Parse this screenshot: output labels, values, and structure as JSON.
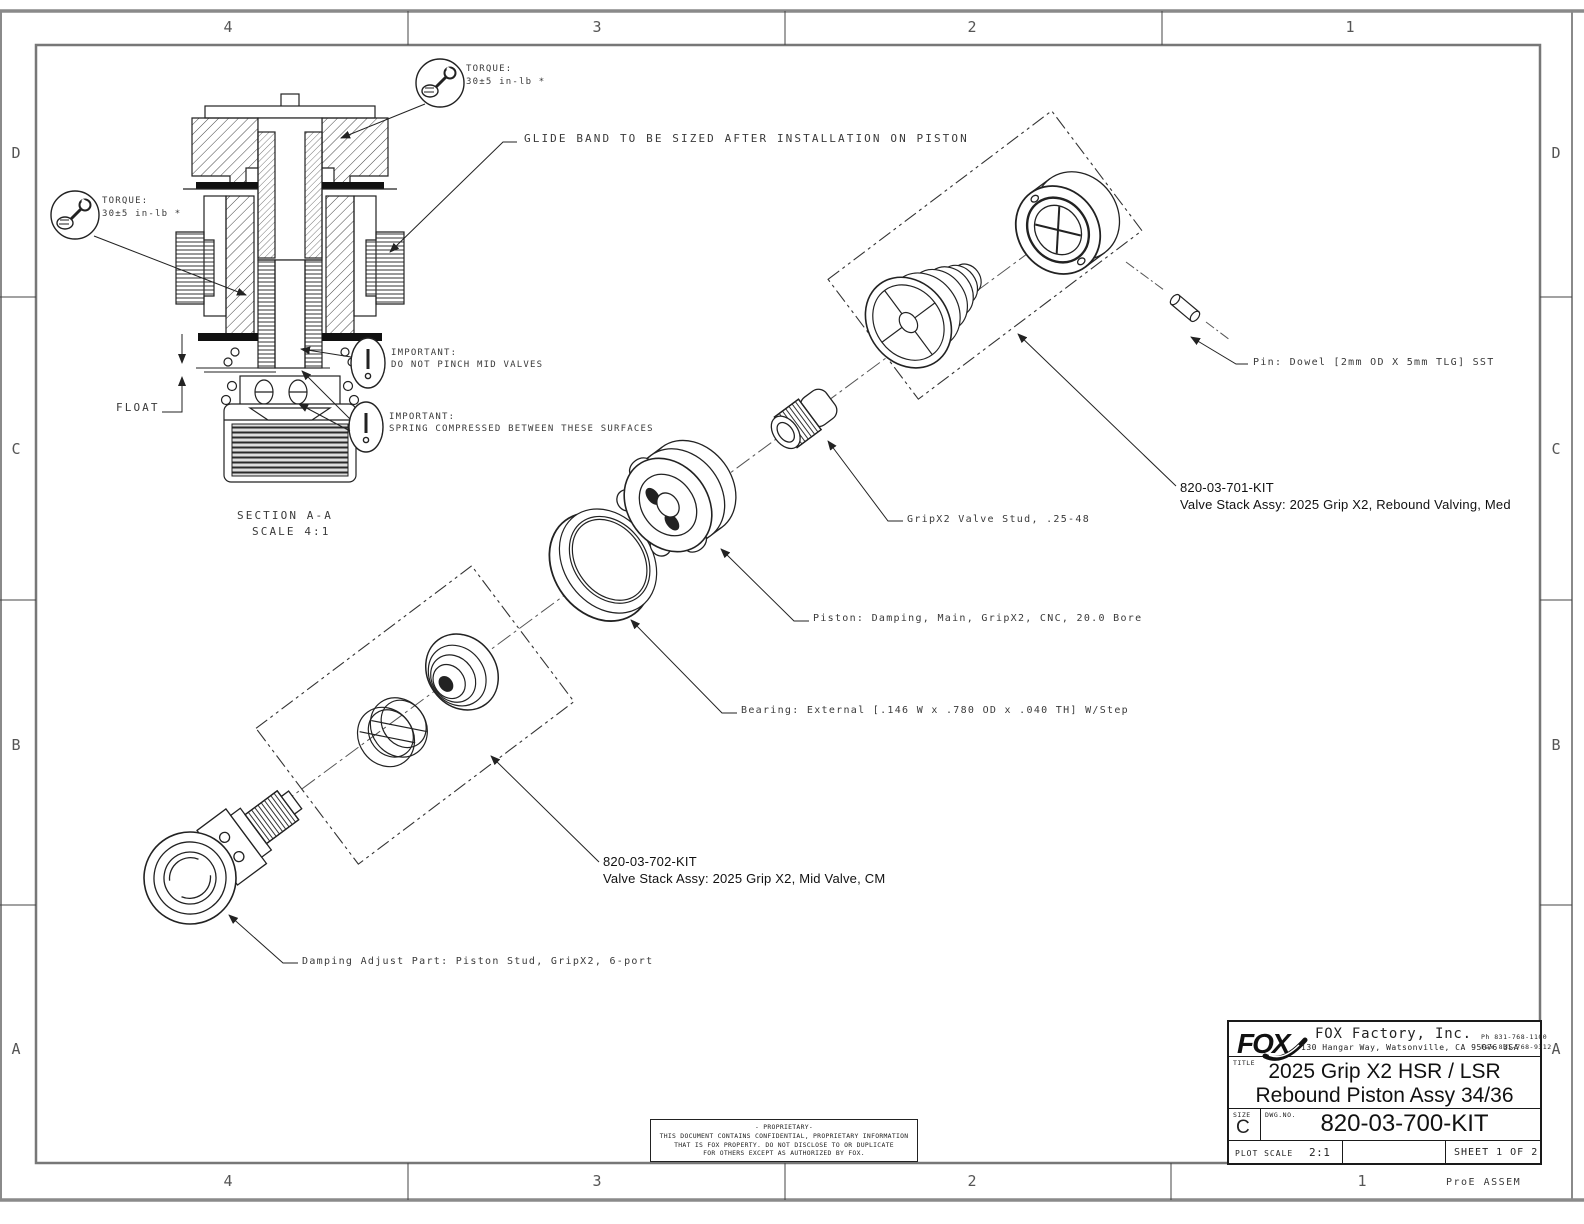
{
  "sheet": {
    "zones_top": [
      "4",
      "3",
      "2",
      "1"
    ],
    "zones_bottom": [
      "4",
      "3",
      "2",
      "1"
    ],
    "zones_left": [
      "D",
      "C",
      "B",
      "A"
    ],
    "zones_right": [
      "D",
      "C",
      "B",
      "A"
    ],
    "footer_note": "ProE ASSEM"
  },
  "section_view": {
    "title": "SECTION A-A",
    "scale": "SCALE 4:1",
    "float_label": "FLOAT",
    "glide_note": "GLIDE BAND TO BE SIZED AFTER INSTALLATION ON PISTON",
    "torque_label": "TORQUE:",
    "torque_value": "30±5 in-lb *",
    "important_label": "IMPORTANT:",
    "important_1": "DO NOT PINCH MID VALVES",
    "important_2": "SPRING COMPRESSED BETWEEN THESE SURFACES"
  },
  "exploded": {
    "pin": "Pin: Dowel [2mm OD X 5mm TLG] SST",
    "kit_701": "820-03-701-KIT",
    "kit_701_desc": "Valve Stack Assy: 2025 Grip X2, Rebound Valving, Med",
    "stud": "GripX2 Valve Stud, .25-48",
    "piston": "Piston: Damping, Main, GripX2, CNC, 20.0 Bore",
    "bearing": "Bearing: External [.146 W x .780 OD x .040 TH] W/Step",
    "kit_702": "820-03-702-KIT",
    "kit_702_desc": "Valve Stack Assy: 2025 Grip X2, Mid Valve, CM",
    "damping": "Damping Adjust Part: Piston Stud, GripX2, 6-port"
  },
  "title_block": {
    "logo": "FOX",
    "company": "FOX Factory, Inc.",
    "address": "130 Hangar Way, Watsonville, CA 95076 USA",
    "phone": "Ph 831-768-1100",
    "fax": "Fax 831-768-9312",
    "title_label": "TITLE",
    "title_line1": "2025 Grip X2 HSR / LSR",
    "title_line2": "Rebound Piston Assy 34/36",
    "size_label": "SIZE",
    "size_value": "C",
    "dwg_label": "DWG.NO.",
    "dwg_no": "820-03-700-KIT",
    "plot_scale_label": "PLOT SCALE",
    "plot_scale_value": "2:1",
    "sheet_info": "SHEET 1 OF 2"
  },
  "proprietary": {
    "line1": "- PROPRIETARY-",
    "line2": "THIS DOCUMENT CONTAINS CONFIDENTIAL, PROPRIETARY INFORMATION",
    "line3": "THAT IS FOX PROPERTY.  DO NOT DISCLOSE TO OR DUPLICATE",
    "line4": "FOR OTHERS EXCEPT AS AUTHORIZED BY FOX."
  }
}
